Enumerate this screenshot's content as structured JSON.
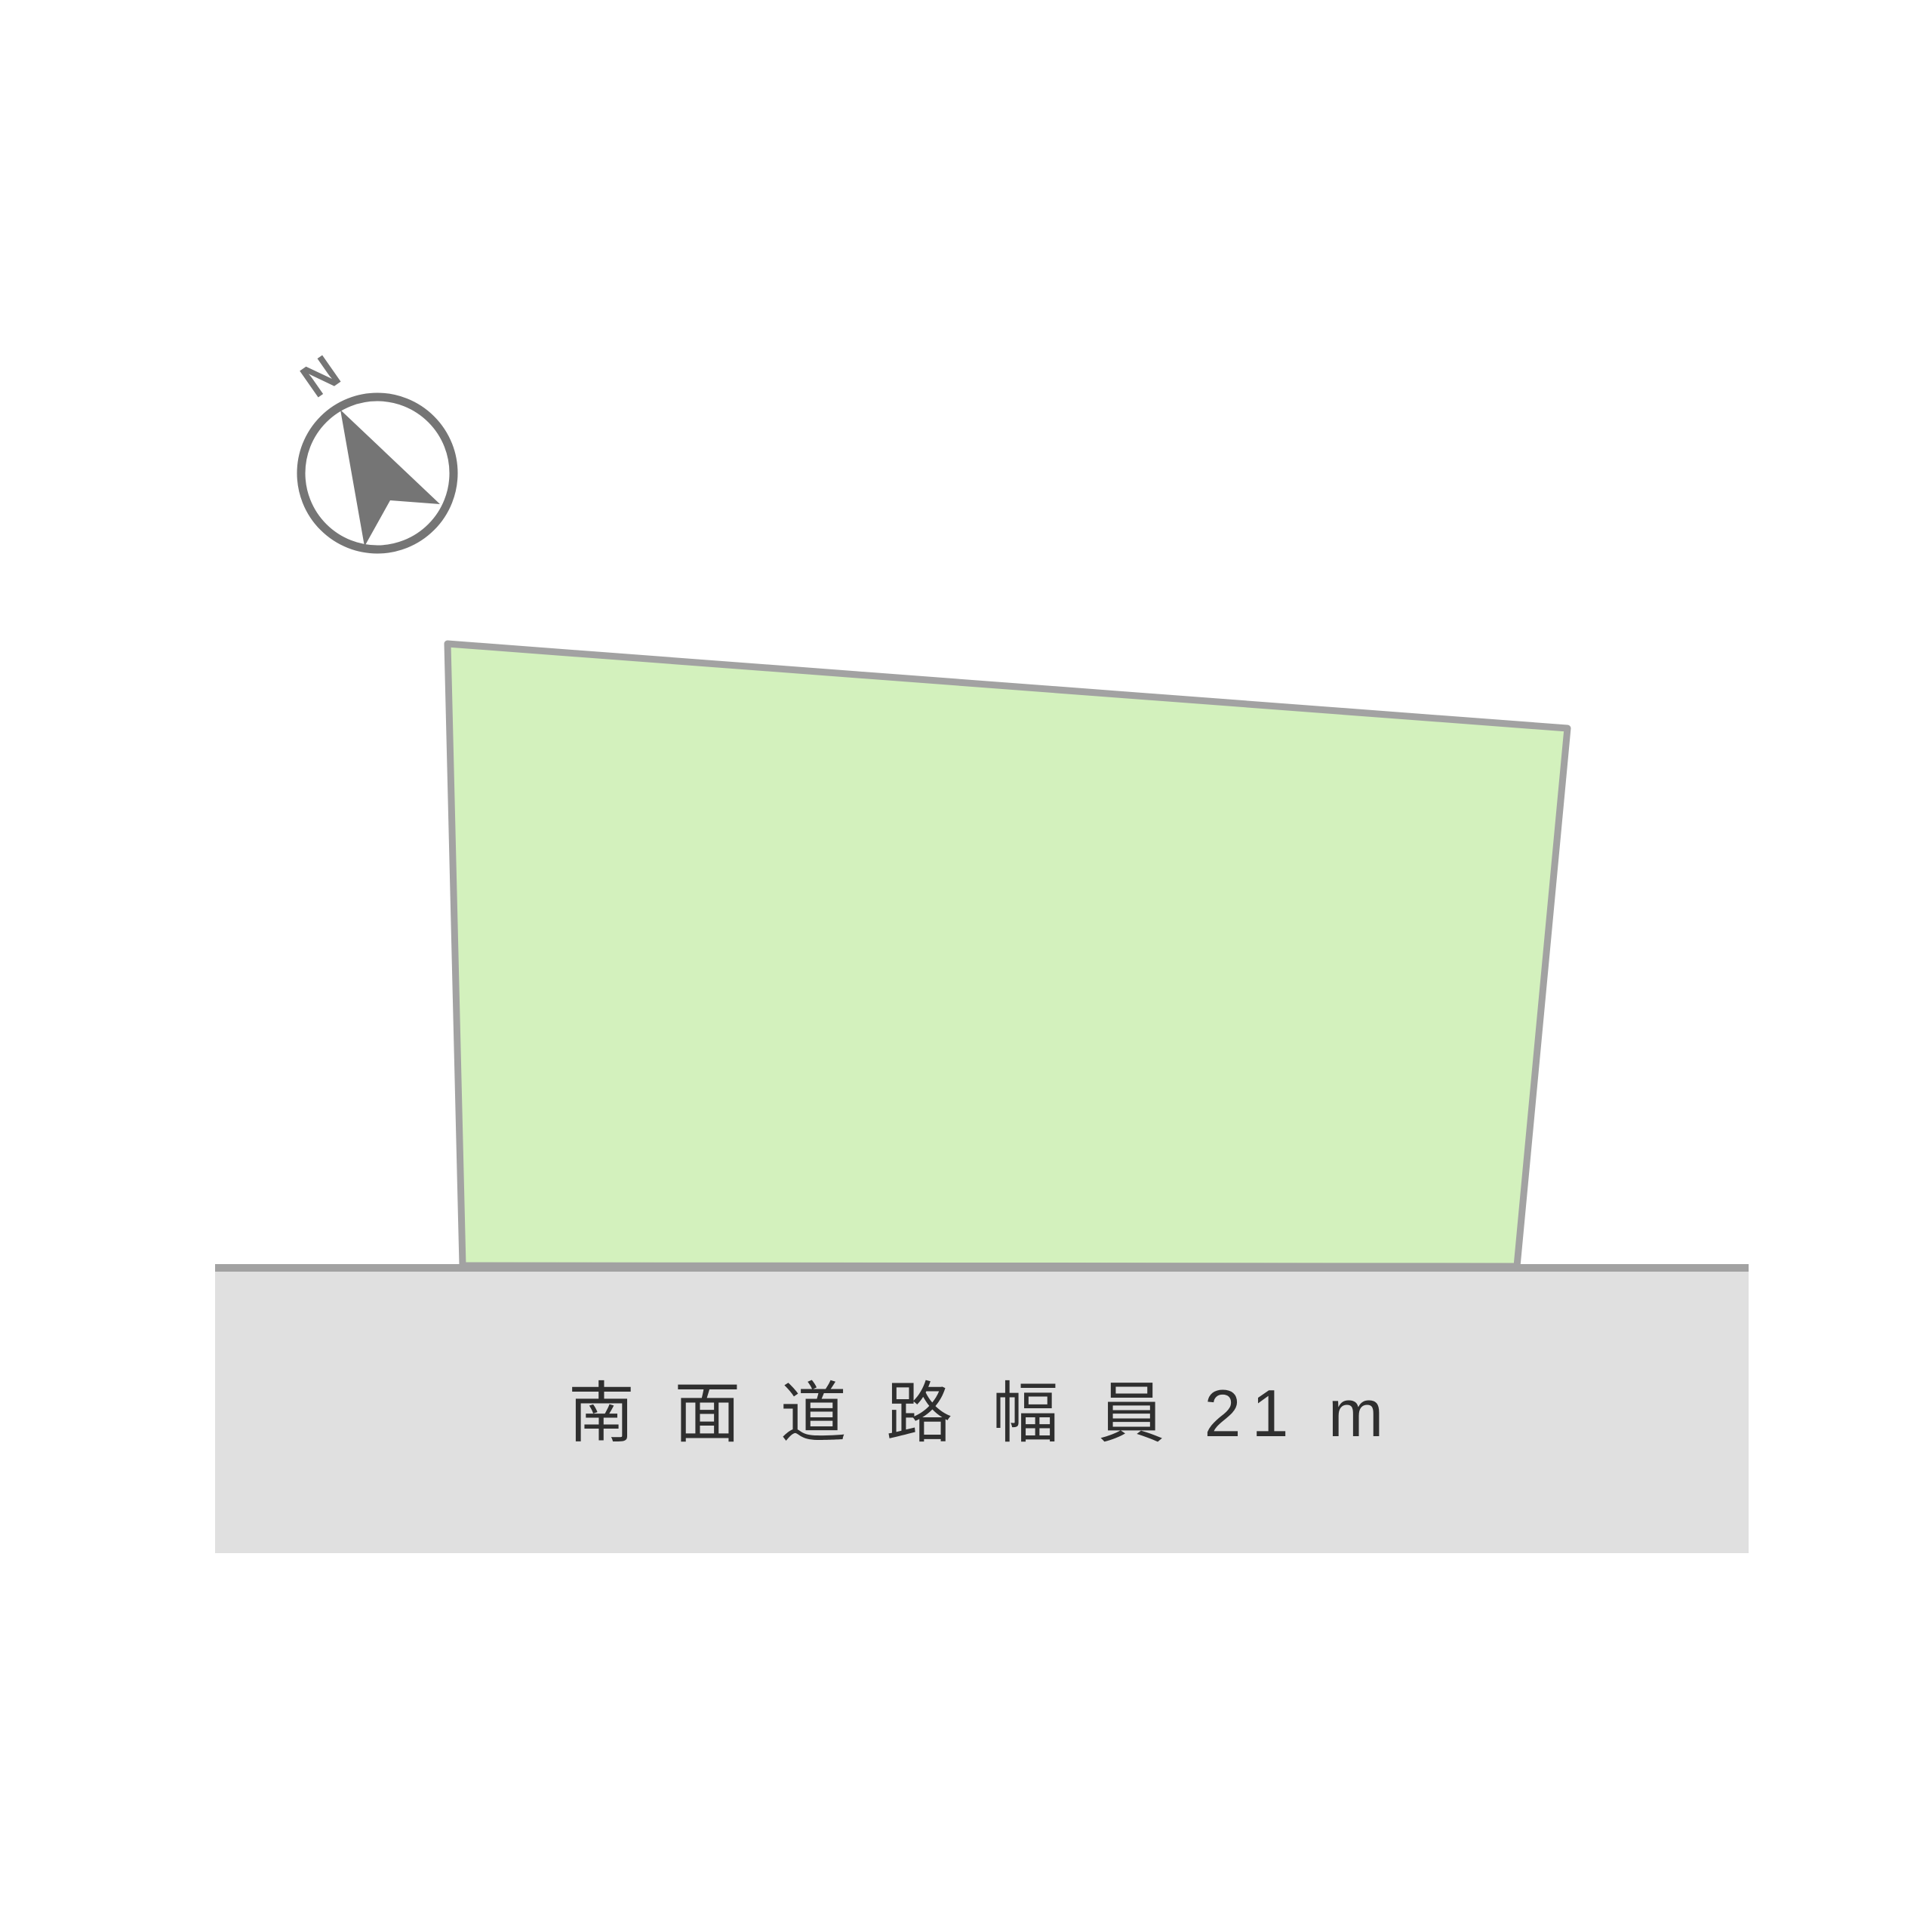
{
  "diagram": {
    "compass": {
      "label": "N",
      "color": "#757575"
    },
    "land": {
      "fill": "#d3f1bd",
      "stroke": "#a2a2a2"
    },
    "road": {
      "label": "南 面 道 路 幅 員 21 m",
      "fill": "#e0e0e0",
      "border": "#a2a2a2",
      "text_color": "#2f2f2f"
    },
    "background": "#ffffff"
  }
}
